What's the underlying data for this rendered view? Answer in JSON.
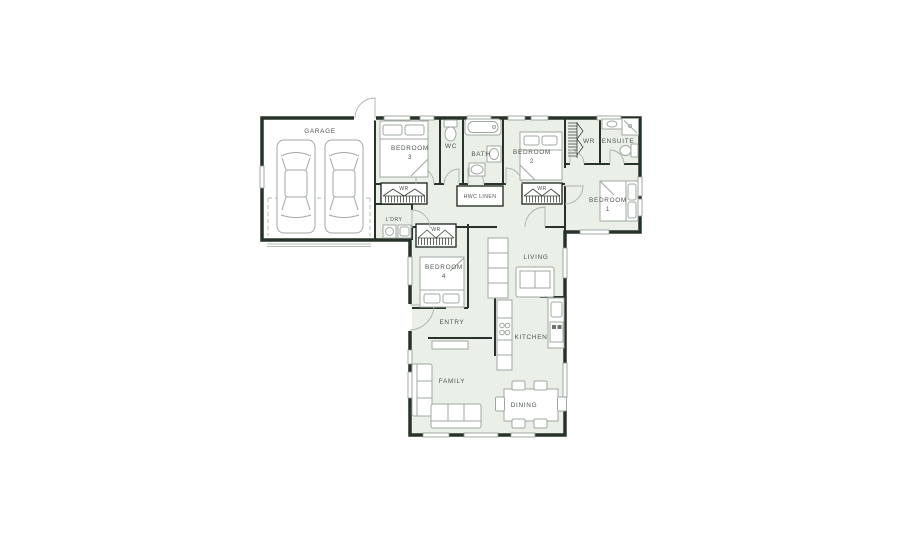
{
  "colors": {
    "floor_tint": "#eaf0e8",
    "wall": "#273229",
    "furniture_line": "#9fa8a0",
    "label_text": "#4d564d",
    "window_line": "#8d978d",
    "door_arc": "#aab2aa"
  },
  "rooms": {
    "garage": {
      "label": "GARAGE"
    },
    "bedroom3": {
      "label": "BEDROOM",
      "number": "3"
    },
    "wc": {
      "label": "WC"
    },
    "bath": {
      "label": "BATH"
    },
    "bedroom2": {
      "label": "BEDROOM",
      "number": "2"
    },
    "walk_in_robe": {
      "label": "WR"
    },
    "ensuite": {
      "label": "ENSUITE"
    },
    "bedroom1": {
      "label": "BEDROOM",
      "number": "1"
    },
    "wardrobe_bed3": {
      "label": "WR"
    },
    "hwc_linen": {
      "label": "HWC LINEN"
    },
    "wardrobe_bed2": {
      "label": "WR"
    },
    "laundry": {
      "label": "L'DRY"
    },
    "wardrobe_bed4": {
      "label": "WR"
    },
    "bedroom4": {
      "label": "BEDROOM",
      "number": "4"
    },
    "living": {
      "label": "LIVING"
    },
    "entry": {
      "label": "ENTRY"
    },
    "kitchen": {
      "label": "KITCHEN"
    },
    "family": {
      "label": "FAMILY"
    },
    "dining": {
      "label": "DINING"
    }
  }
}
